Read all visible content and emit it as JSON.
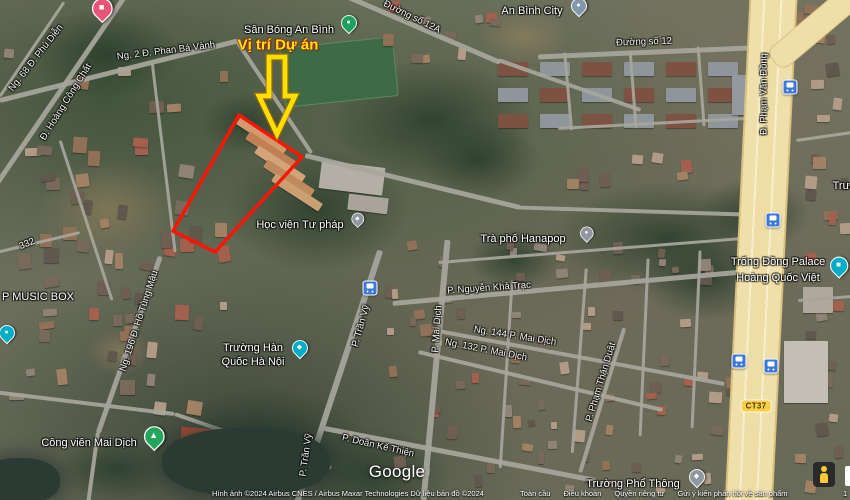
{
  "annotation": {
    "label": "Vị trí Dự án",
    "label_color": "#ffe20c",
    "arrow_color": "#ffdf00",
    "polygon_color": "#fb1507",
    "polygon_points": "239,115 302,157 215,252 173,231",
    "arrow_points": "269,57 285,57 285,96 295,96 277,134 259,96 269,96"
  },
  "map_labels": [
    {
      "text": "Ng. 68 Đ. Phú Diễn",
      "x": 36,
      "y": 58,
      "rot": -52,
      "cls": "road-lbl",
      "name": "road-label-phu-dien",
      "inter": false
    },
    {
      "text": "Đ. Hoàng Công Chất",
      "x": 66,
      "y": 102,
      "rot": -58,
      "cls": "road-lbl",
      "name": "road-label-hoang-cong-chat",
      "inter": false
    },
    {
      "text": "Ng. 2 Đ. Phan Bá Vành",
      "x": 166,
      "y": 51,
      "rot": -7,
      "cls": "road-lbl",
      "name": "road-label-phan-ba-vanh",
      "inter": false
    },
    {
      "text": "Sân Bóng An Bình",
      "x": 289,
      "y": 30,
      "rot": 0,
      "cls": "poi-lbl",
      "name": "poi-label-san-bong-an-binh",
      "inter": true
    },
    {
      "text": "Đường số 12A",
      "x": 412,
      "y": 17,
      "rot": 26,
      "cls": "road-lbl",
      "name": "road-label-duong-so-12a",
      "inter": false
    },
    {
      "text": "An Bình City",
      "x": 532,
      "y": 11,
      "rot": 0,
      "cls": "poi-lbl",
      "name": "poi-label-an-binh-city",
      "inter": true
    },
    {
      "text": "Đường số 12",
      "x": 644,
      "y": 42,
      "rot": -2,
      "cls": "road-lbl",
      "name": "road-label-duong-so-12",
      "inter": false
    },
    {
      "text": "Đ. Phạm Văn Đồng",
      "x": 764,
      "y": 94,
      "rot": -90,
      "cls": "road-lbl",
      "name": "road-label-pham-van-dong",
      "inter": false
    },
    {
      "text": "Học viện Tư pháp",
      "x": 300,
      "y": 225,
      "rot": 0,
      "cls": "poi-lbl",
      "name": "poi-label-hoc-vien-tu-phap",
      "inter": true
    },
    {
      "text": "Trà phố Hanapop",
      "x": 523,
      "y": 239,
      "rot": 0,
      "cls": "poi-lbl",
      "name": "poi-label-tra-pho-hanapop",
      "inter": true
    },
    {
      "text": "Trống Đồng Palace",
      "x": 778,
      "y": 262,
      "rot": 0,
      "cls": "poi-lbl",
      "name": "poi-label-trong-dong-palace",
      "inter": true
    },
    {
      "text": "Hoàng Quốc Việt",
      "x": 778,
      "y": 278,
      "rot": 0,
      "cls": "poi-lbl",
      "name": "poi-label-trong-dong-palace-line2",
      "inter": true
    },
    {
      "text": "Trường",
      "x": 851,
      "y": 186,
      "rot": 0,
      "cls": "poi-lbl",
      "name": "poi-label-truncated-right-edge",
      "inter": true
    },
    {
      "text": "P. Nguyễn Khả Trạc",
      "x": 489,
      "y": 288,
      "rot": -4,
      "cls": "road-lbl",
      "name": "road-label-nguyen-kha-trac",
      "inter": false
    },
    {
      "text": "Ng. 144 P. Mai Dịch",
      "x": 515,
      "y": 336,
      "rot": 9,
      "cls": "road-lbl",
      "name": "road-label-ng-144-mai-dich",
      "inter": false
    },
    {
      "text": "Ng. 132 P. Mai Dịch",
      "x": 486,
      "y": 350,
      "rot": 11,
      "cls": "road-lbl",
      "name": "road-label-ng-132-mai-dich",
      "inter": false
    },
    {
      "text": "P. Mai Dịch",
      "x": 437,
      "y": 329,
      "rot": -86,
      "cls": "road-lbl",
      "name": "road-label-mai-dich",
      "inter": false
    },
    {
      "text": "P. Phạm Thận Duật",
      "x": 601,
      "y": 382,
      "rot": -73,
      "cls": "road-lbl",
      "name": "road-label-pham-than-duat",
      "inter": false
    },
    {
      "text": "P. Trần Vỹ",
      "x": 361,
      "y": 326,
      "rot": -74,
      "cls": "road-lbl",
      "name": "road-label-tran-vy-upper",
      "inter": false
    },
    {
      "text": "P. Trần Vỹ",
      "x": 306,
      "y": 455,
      "rot": -82,
      "cls": "road-lbl",
      "name": "road-label-tran-vy-lower",
      "inter": false
    },
    {
      "text": "P. Doãn Kế Thiện",
      "x": 378,
      "y": 446,
      "rot": 13,
      "cls": "road-lbl",
      "name": "road-label-doan-ke-thien",
      "inter": false
    },
    {
      "text": "Ng. 196 Đ. Hồ Tùng Mậu",
      "x": 139,
      "y": 321,
      "rot": -72,
      "cls": "road-lbl",
      "name": "road-label-ho-tung-mau",
      "inter": false
    },
    {
      "text": "332",
      "x": 27,
      "y": 244,
      "rot": -22,
      "cls": "road-lbl",
      "name": "road-label-332",
      "inter": false
    },
    {
      "text": "P MUSIC BOX",
      "x": 38,
      "y": 297,
      "rot": 0,
      "cls": "poi-lbl",
      "name": "poi-label-music-box",
      "inter": true
    },
    {
      "text": "Công viên Mai Dịch",
      "x": 89,
      "y": 443,
      "rot": 0,
      "cls": "poi-lbl",
      "name": "poi-label-cong-vien-mai-dich",
      "inter": true
    },
    {
      "text": "Trường Hàn",
      "x": 253,
      "y": 348,
      "rot": 0,
      "cls": "poi-lbl",
      "name": "poi-label-truong-han-quoc-line1",
      "inter": true
    },
    {
      "text": "Quốc Hà Nội",
      "x": 253,
      "y": 362,
      "rot": 0,
      "cls": "poi-lbl",
      "name": "poi-label-truong-han-quoc-line2",
      "inter": true
    },
    {
      "text": "Trường Phổ Thông",
      "x": 633,
      "y": 484,
      "rot": 0,
      "cls": "poi-lbl",
      "name": "poi-label-truong-pho-thong",
      "inter": true
    }
  ],
  "pins": [
    {
      "name": "lodging-pin",
      "color": "#e8537a",
      "x": 101,
      "y": 28,
      "s": 1.3,
      "glyph": "■"
    },
    {
      "name": "sports-field-pin",
      "color": "#1ea05e",
      "x": 348,
      "y": 38,
      "s": 1.0,
      "glyph": "●"
    },
    {
      "name": "city-pin",
      "color": "#8398ab",
      "x": 578,
      "y": 21,
      "s": 1.0,
      "glyph": "●"
    },
    {
      "name": "school-pin",
      "color": "#9097a0",
      "x": 357,
      "y": 231,
      "s": 0.8,
      "glyph": "◆"
    },
    {
      "name": "poi-pin",
      "color": "#9097a0",
      "x": 586,
      "y": 246,
      "s": 0.85,
      "glyph": "●"
    },
    {
      "name": "palace-pin",
      "color": "#00afc5",
      "x": 838,
      "y": 283,
      "s": 1.15,
      "glyph": "■"
    },
    {
      "name": "school-pin",
      "color": "#00afc5",
      "x": 299,
      "y": 363,
      "s": 1.0,
      "glyph": "◆"
    },
    {
      "name": "park-pin",
      "color": "#23a55b",
      "x": 153,
      "y": 456,
      "s": 1.3,
      "glyph": "▲"
    },
    {
      "name": "school-pin",
      "color": "#9097a0",
      "x": 696,
      "y": 492,
      "s": 1.0,
      "glyph": "◆"
    },
    {
      "name": "poi-pin",
      "color": "#00afc5",
      "x": 6,
      "y": 348,
      "s": 1.0,
      "glyph": "●"
    }
  ],
  "transit_stops": [
    {
      "x": 790,
      "y": 87
    },
    {
      "x": 773,
      "y": 220
    },
    {
      "x": 739,
      "y": 361
    },
    {
      "x": 771,
      "y": 366
    },
    {
      "x": 370,
      "y": 288
    }
  ],
  "road_badge": {
    "text": "CT37",
    "x": 756,
    "y": 406
  },
  "watermark": "Google",
  "footer": {
    "attribution": "Hình ảnh ©2024 Airbus CNES / Airbus Maxar Technologies Dữ liệu bản đồ ©2024",
    "links": [
      "Toàn cầu",
      "Điều khoản",
      "Quyền riêng tư",
      "Gửi ý kiến phản hồi về sản phẩm"
    ],
    "scale_partial": "1"
  }
}
